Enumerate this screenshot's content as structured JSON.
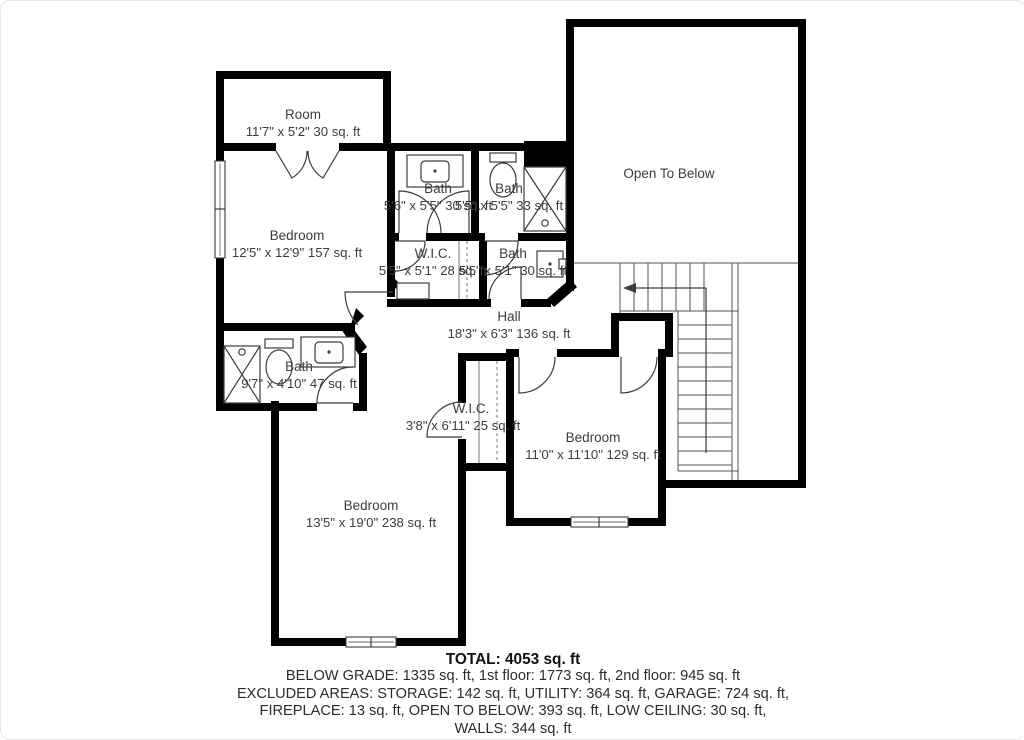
{
  "title": "Second floor plan",
  "colors": {
    "wall": "#000000",
    "background": "#ffffff",
    "text": "#3d3d3d"
  },
  "rooms": [
    {
      "name": "Room",
      "dims": "11'7\" x 5'2\" 30 sq. ft"
    },
    {
      "name": "Bedroom",
      "dims": "12'5\" x 12'9\" 157 sq. ft"
    },
    {
      "name": "Bath",
      "dims": "5'6\" x 5'5\" 30 sq. ft"
    },
    {
      "name": "Bath",
      "dims": "5'5\" x 5'5\" 33 sq. ft"
    },
    {
      "name": "W.I.C.",
      "dims": "5'5\" x 5'1\" 28 sq. ft"
    },
    {
      "name": "Bath",
      "dims": "5'5\" x 5'1\" 30 sq. ft"
    },
    {
      "name": "Open To Below",
      "dims": ""
    },
    {
      "name": "Hall",
      "dims": "18'3\" x 6'3\" 136 sq. ft"
    },
    {
      "name": "Bath",
      "dims": "9'7\" x 4'10\" 47 sq. ft"
    },
    {
      "name": "W.I.C.",
      "dims": "3'8\" x 6'11\" 25 sq. ft"
    },
    {
      "name": "Bedroom",
      "dims": "11'0\" x 11'10\" 129 sq. ft"
    },
    {
      "name": "Bedroom",
      "dims": "13'5\" x 19'0\" 238 sq. ft"
    }
  ],
  "summary": {
    "total": "TOTAL: 4053 sq. ft",
    "line1": "BELOW GRADE: 1335 sq. ft, 1st floor: 1773 sq. ft, 2nd floor: 945 sq. ft",
    "line2": "EXCLUDED AREAS: STORAGE: 142 sq. ft, UTILITY: 364 sq. ft, GARAGE: 724 sq. ft,",
    "line3": "FIREPLACE: 13 sq. ft, OPEN TO BELOW: 393 sq. ft, LOW CEILING: 30 sq. ft,",
    "line4": "WALLS: 344 sq. ft"
  }
}
